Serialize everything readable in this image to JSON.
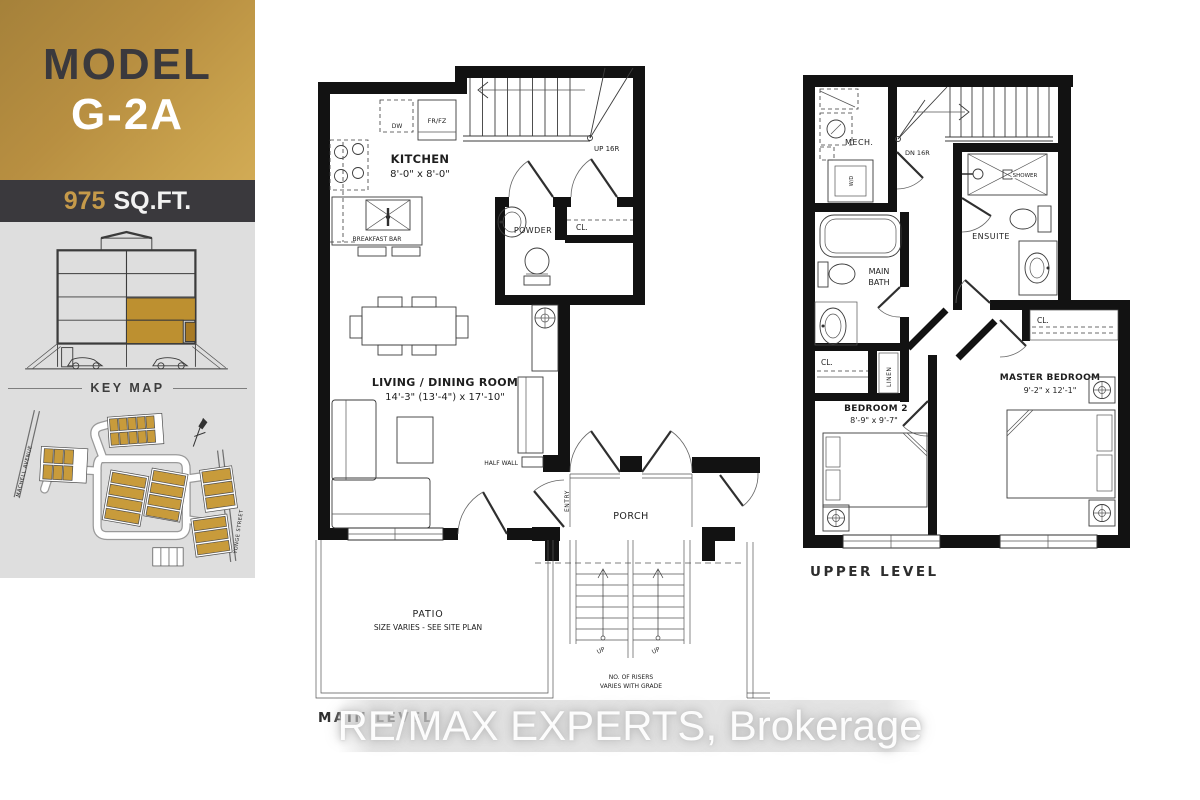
{
  "sidebar": {
    "model_label": "MODEL",
    "model_name": "G-2A",
    "sqft_value": "975",
    "sqft_unit": "SQ.FT.",
    "key_map_label": "KEY MAP",
    "street_left": "MACHELL AVENUE",
    "street_right": "YONGE STREET"
  },
  "main_level": {
    "title": "MAIN LEVEL",
    "kitchen_name": "KITCHEN",
    "kitchen_dims": "8'-0\" x 8'-0\"",
    "living_name": "LIVING / DINING ROOM",
    "living_dims": "14'-3\" (13'-4\") x 17'-10\"",
    "powder": "POWDER",
    "closet": "CL.",
    "porch": "PORCH",
    "patio_name": "PATIO",
    "patio_note": "SIZE VARIES - SEE SITE PLAN",
    "breakfast_bar": "BREAKFAST BAR",
    "dishwasher": "DW",
    "fridge": "FR/FZ",
    "stairs_up": "UP 16R",
    "half_wall": "HALF WALL",
    "entry": "ENTRY",
    "up_left": "UP",
    "up_right": "UP",
    "risers_line1": "NO. OF RISERS",
    "risers_line2": "VARIES WITH GRADE"
  },
  "upper_level": {
    "title": "UPPER LEVEL",
    "mech": "MECH.",
    "washer_dryer": "W/D",
    "stairs_down": "DN 16R",
    "shower": "SHOWER",
    "ensuite": "ENSUITE",
    "main_bath_line1": "MAIN",
    "main_bath_line2": "BATH",
    "closet_hall": "CL.",
    "linen": "LINEN",
    "closet_master": "CL.",
    "bedroom2_name": "BEDROOM 2",
    "bedroom2_dims": "8'-9\" x 9'-7\"",
    "master_name": "MASTER BEDROOM",
    "master_dims": "9'-2\" x 12'-1\""
  },
  "watermark": "RE/MAX EXPERTS, Brokerage",
  "colors": {
    "gold": "#c49a4a",
    "gold_gradient_start": "#a5813a",
    "gold_gradient_end": "#d2ab55",
    "dark_bar": "#3a393d",
    "panel_gray": "#dedede",
    "map_unit_gold": "#c89b3b",
    "plan_wall": "#121212"
  }
}
